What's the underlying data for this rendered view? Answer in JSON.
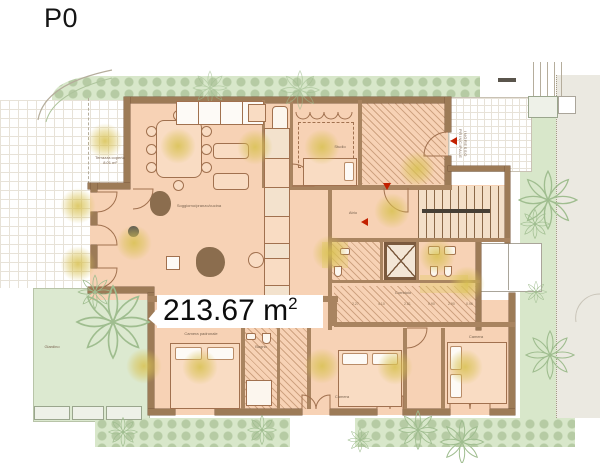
{
  "title": "P0",
  "area": {
    "number": "213.67",
    "unit": "m",
    "sup": "2"
  },
  "rooms": {
    "terrace": "Terrazza coperta",
    "terrace_area": "8.01 m²",
    "living": "Soggiorno/pranzo/cucina",
    "studio": "Studio",
    "atrio": "Atrio",
    "master": "Camera padronale",
    "bedroom2": "Camera",
    "bedroom3": "Camera",
    "bath": "Bagno",
    "corridor": "Corridoio",
    "garden": "Giardino",
    "entrance": "INGRESSO PRINCIPALE"
  },
  "dims": [
    "2.27",
    "4.10",
    "2.81",
    "0.90",
    "2.90",
    "0.96"
  ],
  "colors": {
    "floor": "#f7d2b5",
    "wall": "#9d7b57",
    "wall_dark": "#7b5a3e",
    "garden_green": "#d8e7ca",
    "plant_line": "#9fbd8f",
    "glow": "#d8c150",
    "marker_red": "#c22000",
    "paving_grid": "#e7e2d8"
  }
}
